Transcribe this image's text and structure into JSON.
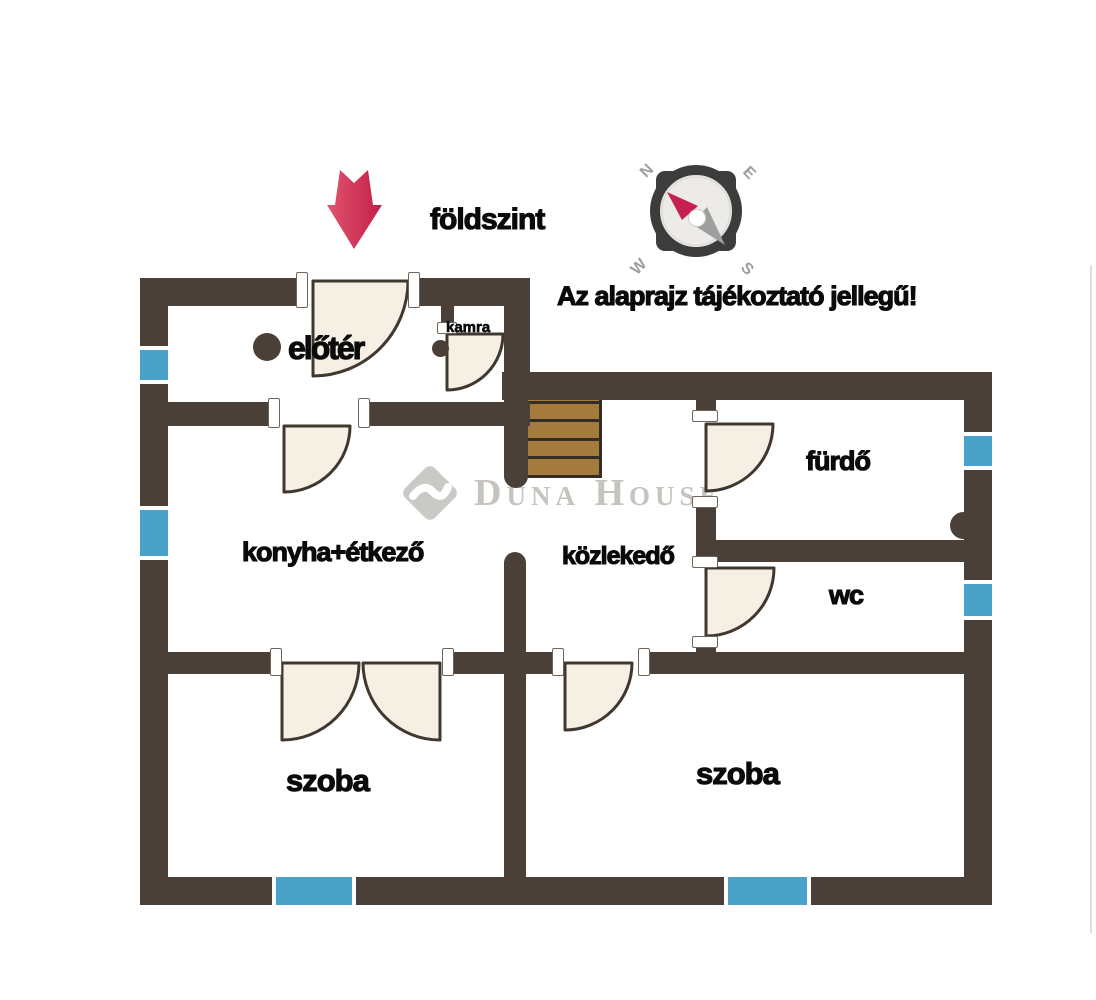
{
  "header": {
    "floor_label": "földszint",
    "disclaimer": "Az alaprajz tájékoztató jellegű!"
  },
  "compass": {
    "north": "N",
    "east": "E",
    "west": "W",
    "south": "S"
  },
  "watermark": {
    "brand": "Duna House",
    "registered": "®"
  },
  "rooms": {
    "eloter": "előtér",
    "kamra": "kamra",
    "konyha": "konyha+étkező",
    "kozlekedo": "közlekedő",
    "furdo": "fürdő",
    "wc": "wc",
    "szoba_left": "szoba",
    "szoba_right": "szoba"
  },
  "colors": {
    "wall": "#4a4037",
    "window": "#4aa2c9",
    "window-frame": "#ffffff",
    "door-fill": "#f6efe3",
    "door-stroke": "#40382e",
    "stair-fill": "#a57a3e",
    "stair-line": "#352d24",
    "arrow1": "#e0546f",
    "arrow2": "#c21f47",
    "ink": "#0a0a0a",
    "watermark": "#c7c4c0",
    "compass-dark": "#3c3c3c",
    "compass-face": "#e9e7e4",
    "needle-red": "#c52050",
    "needle-gray": "#9e9e9e"
  }
}
